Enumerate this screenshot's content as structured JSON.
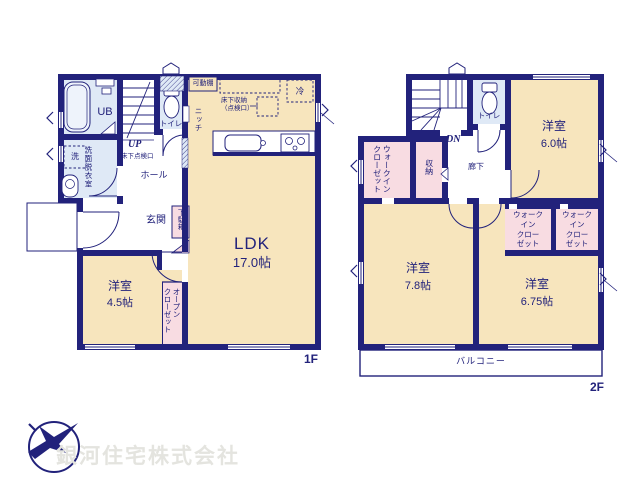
{
  "colors": {
    "wall": "#22227b",
    "room_cream": "#f7e5bd",
    "wet_blue": "#dfe9f6",
    "closet_pink": "#f8dce2",
    "logo_navy": "#22227b",
    "watermark_gray": "#e4e4df"
  },
  "floor1": {
    "label": "1F",
    "ub": "UB",
    "washer": "洗",
    "washroom": "洗面脱衣室",
    "toilet": "トイレ",
    "stairs": "UP",
    "underfloor_hatch": "床下点検口",
    "movable_shelf": "可動棚",
    "niche": "ニッチ",
    "underfloor_storage": "床下収納\n（点検口）",
    "fridge": "冷",
    "hall": "ホール",
    "entrance": "玄関",
    "shoe_cabinet": "下駄箱",
    "ldk": {
      "name": "LDK",
      "area": "17.0帖"
    },
    "bedroom": {
      "name": "洋室",
      "area": "4.5帖"
    },
    "open_closet": "オープン\nクローゼット"
  },
  "floor2": {
    "label": "2F",
    "stairs": "DN",
    "toilet": "トイレ",
    "hallway": "廊下",
    "storage": "収納",
    "wic_left": "ウォークイン\nクローゼット",
    "wic_center": "ウォーク\nイン\nクロー\nゼット",
    "wic_right": "ウォーク\nイン\nクロー\nゼット",
    "bedroom1": {
      "name": "洋室",
      "area": "6.0帖"
    },
    "bedroom2": {
      "name": "洋室",
      "area": "7.8帖"
    },
    "bedroom3": {
      "name": "洋室",
      "area": "6.75帖"
    },
    "balcony": "バルコニー"
  },
  "company": {
    "name": "銀河住宅株式会社"
  }
}
